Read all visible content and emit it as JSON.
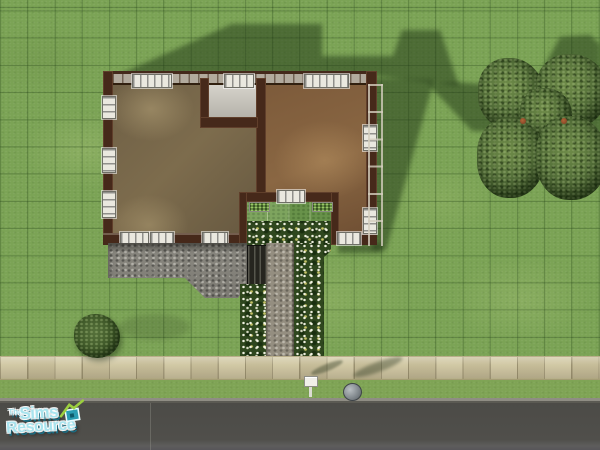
{
  "watermark": {
    "the": "The",
    "sims": "Sims",
    "resource": "Resource",
    "accent_color": "#a9e4ee",
    "icon": "tsr-house-icon"
  },
  "scene": {
    "view": "top-down lot view with floor-plan walls",
    "objects": [
      "house",
      "left-room",
      "right-room",
      "alcove-room",
      "courtyard",
      "gravel-patio",
      "stairs",
      "flower-beds",
      "gravel-path",
      "sidewalk",
      "road",
      "mailbox",
      "trash-can",
      "bush",
      "tree-cluster",
      "roof-shadow"
    ],
    "palette": {
      "grass": "#7ba355",
      "wall_brown": "#46291a",
      "left_room_floor": "#75654a",
      "right_room_floor": "#7c5a3a",
      "alcove_floor": "#d6d3cb",
      "patio_gray": "#85837c",
      "flower_green": "#2f471e",
      "sidewalk_tan": "#cfc5a0",
      "road_gray": "#4c4b47",
      "shadow_green": "rgba(32,54,22,0.5)"
    },
    "grid_spacing_px": 27.2
  }
}
